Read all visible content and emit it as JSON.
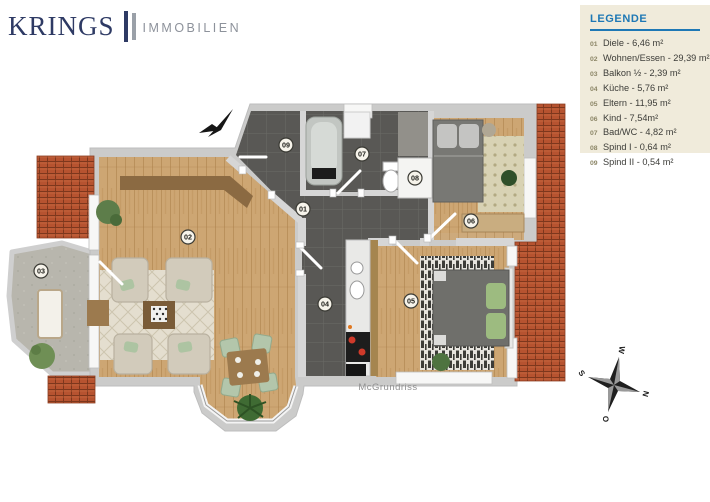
{
  "logo": {
    "name": "KRINGS",
    "subtitle": "IMMOBILIEN"
  },
  "legend": {
    "title": "LEGENDE",
    "items": [
      {
        "num": "01",
        "label": "Diele - 6,46 m²"
      },
      {
        "num": "02",
        "label": "Wohnen/Essen - 29,39 m²"
      },
      {
        "num": "03",
        "label": "Balkon ½ - 2,39 m²"
      },
      {
        "num": "04",
        "label": "Küche - 5,76 m²"
      },
      {
        "num": "05",
        "label": "Eltern - 11,95 m²"
      },
      {
        "num": "06",
        "label": "Kind - 7,54m²"
      },
      {
        "num": "07",
        "label": "Bad/WC - 4,82 m²"
      },
      {
        "num": "08",
        "label": "Spind I - 0,64 m²"
      },
      {
        "num": "09",
        "label": "Spind II - 0,54 m²"
      }
    ]
  },
  "plan": {
    "watermark": "McGrundriss",
    "room_labels": [
      {
        "num": "01"
      },
      {
        "num": "02"
      },
      {
        "num": "03"
      },
      {
        "num": "04"
      },
      {
        "num": "05"
      },
      {
        "num": "06"
      },
      {
        "num": "07"
      },
      {
        "num": "08"
      },
      {
        "num": "09"
      }
    ],
    "compass": {
      "n": "N",
      "e": "O",
      "s": "S",
      "w": "W"
    }
  },
  "colors": {
    "accent_blue": "#1e78b5",
    "legend_bg": "#f0ebdb",
    "roof": "#b65330",
    "wood": "#cda673",
    "tile": "#595855",
    "logo_navy": "#2e3a64",
    "logo_gray": "#8d929b"
  }
}
